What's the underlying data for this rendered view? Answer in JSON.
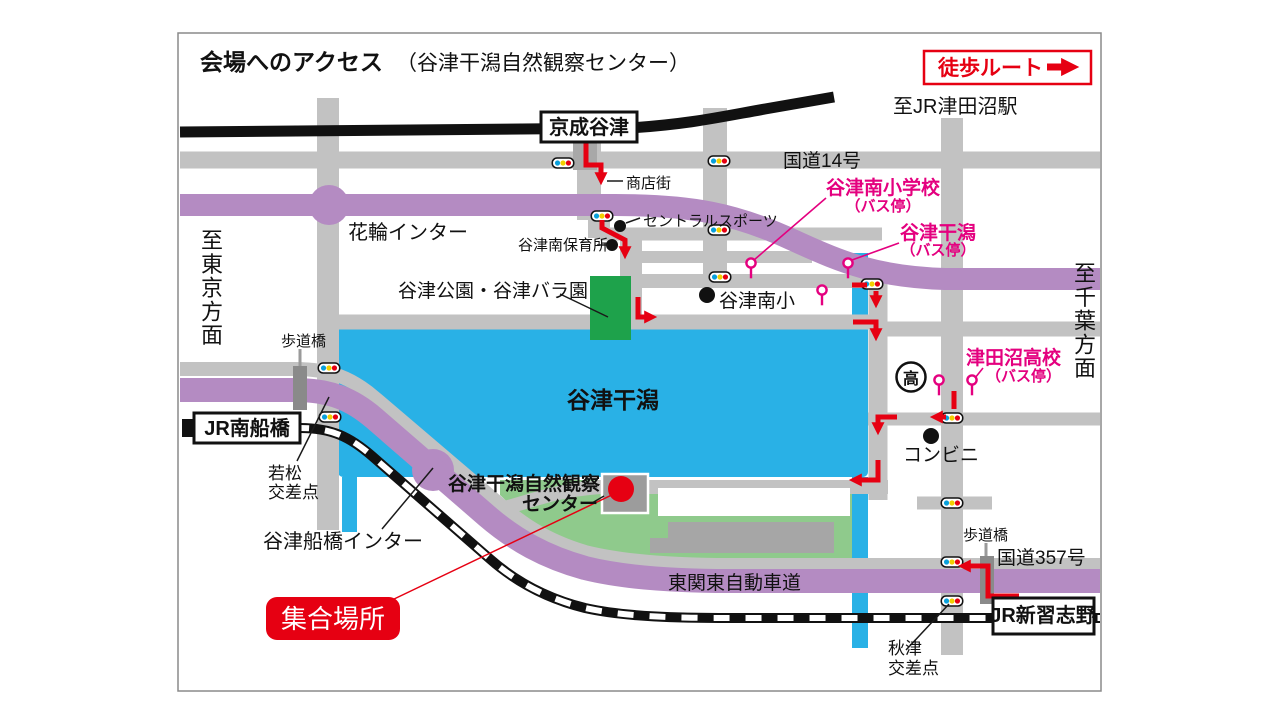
{
  "title": {
    "main": "会場へのアクセス",
    "sub": "（谷津干潟自然観察センター）"
  },
  "legend": {
    "walk_route": "徒歩ルート"
  },
  "directions": {
    "to_jr_tsudanuma": "至JR津田沼駅",
    "to_tokyo": "至東京方面",
    "to_chiba": "至千葉方面"
  },
  "stations": {
    "keisei_yatsu": "京成谷津",
    "jr_minami_funabashi": "JR南船橋",
    "jr_shin_narashino": "JR新習志野"
  },
  "roads": {
    "route14": "国道14号",
    "route357": "国道357号",
    "expressway": "東関東自動車道",
    "shotengai": "商店街"
  },
  "interchanges": {
    "hanawa": "花輪インター",
    "yatsu_funabashi": "谷津船橋インター"
  },
  "crossings": {
    "wakamatsu_l1": "若松",
    "wakamatsu_l2": "交差点",
    "akitsu_l1": "秋津",
    "akitsu_l2": "交差点"
  },
  "bridges": {
    "hodokyo_left": "歩道橋",
    "hodokyo_right": "歩道橋"
  },
  "landmarks": {
    "central_sports": "セントラルスポーツ",
    "hoikusho": "谷津南保育所",
    "park_rose": "谷津公園・谷津バラ園",
    "yatsu_minami_sho": "谷津南小",
    "konbini": "コンビニ",
    "koukou_mark": "高",
    "tidal_flat": "谷津干潟",
    "nature_center_l1": "谷津干潟自然観察",
    "nature_center_l2": "センター"
  },
  "bus_stops": {
    "minami_shogakko_l1": "谷津南小学校",
    "minami_shogakko_l2": "（バス停）",
    "yatsu_higata_l1": "谷津干潟",
    "yatsu_higata_l2": "（バス停）",
    "tsudanuma_koko_l1": "津田沼高校",
    "tsudanuma_koko_l2": "（バス停）"
  },
  "meeting_point": {
    "label": "集合場所"
  },
  "colors": {
    "route_red": "#e60012",
    "bus_pink": "#e4007f",
    "water_blue": "#29b1e6",
    "park_green_light": "#8fca8c",
    "park_green_dark": "#1ea24b",
    "road_gray": "#c2c2c2",
    "highway_purple": "#b48bc2",
    "rail_black": "#111111"
  }
}
